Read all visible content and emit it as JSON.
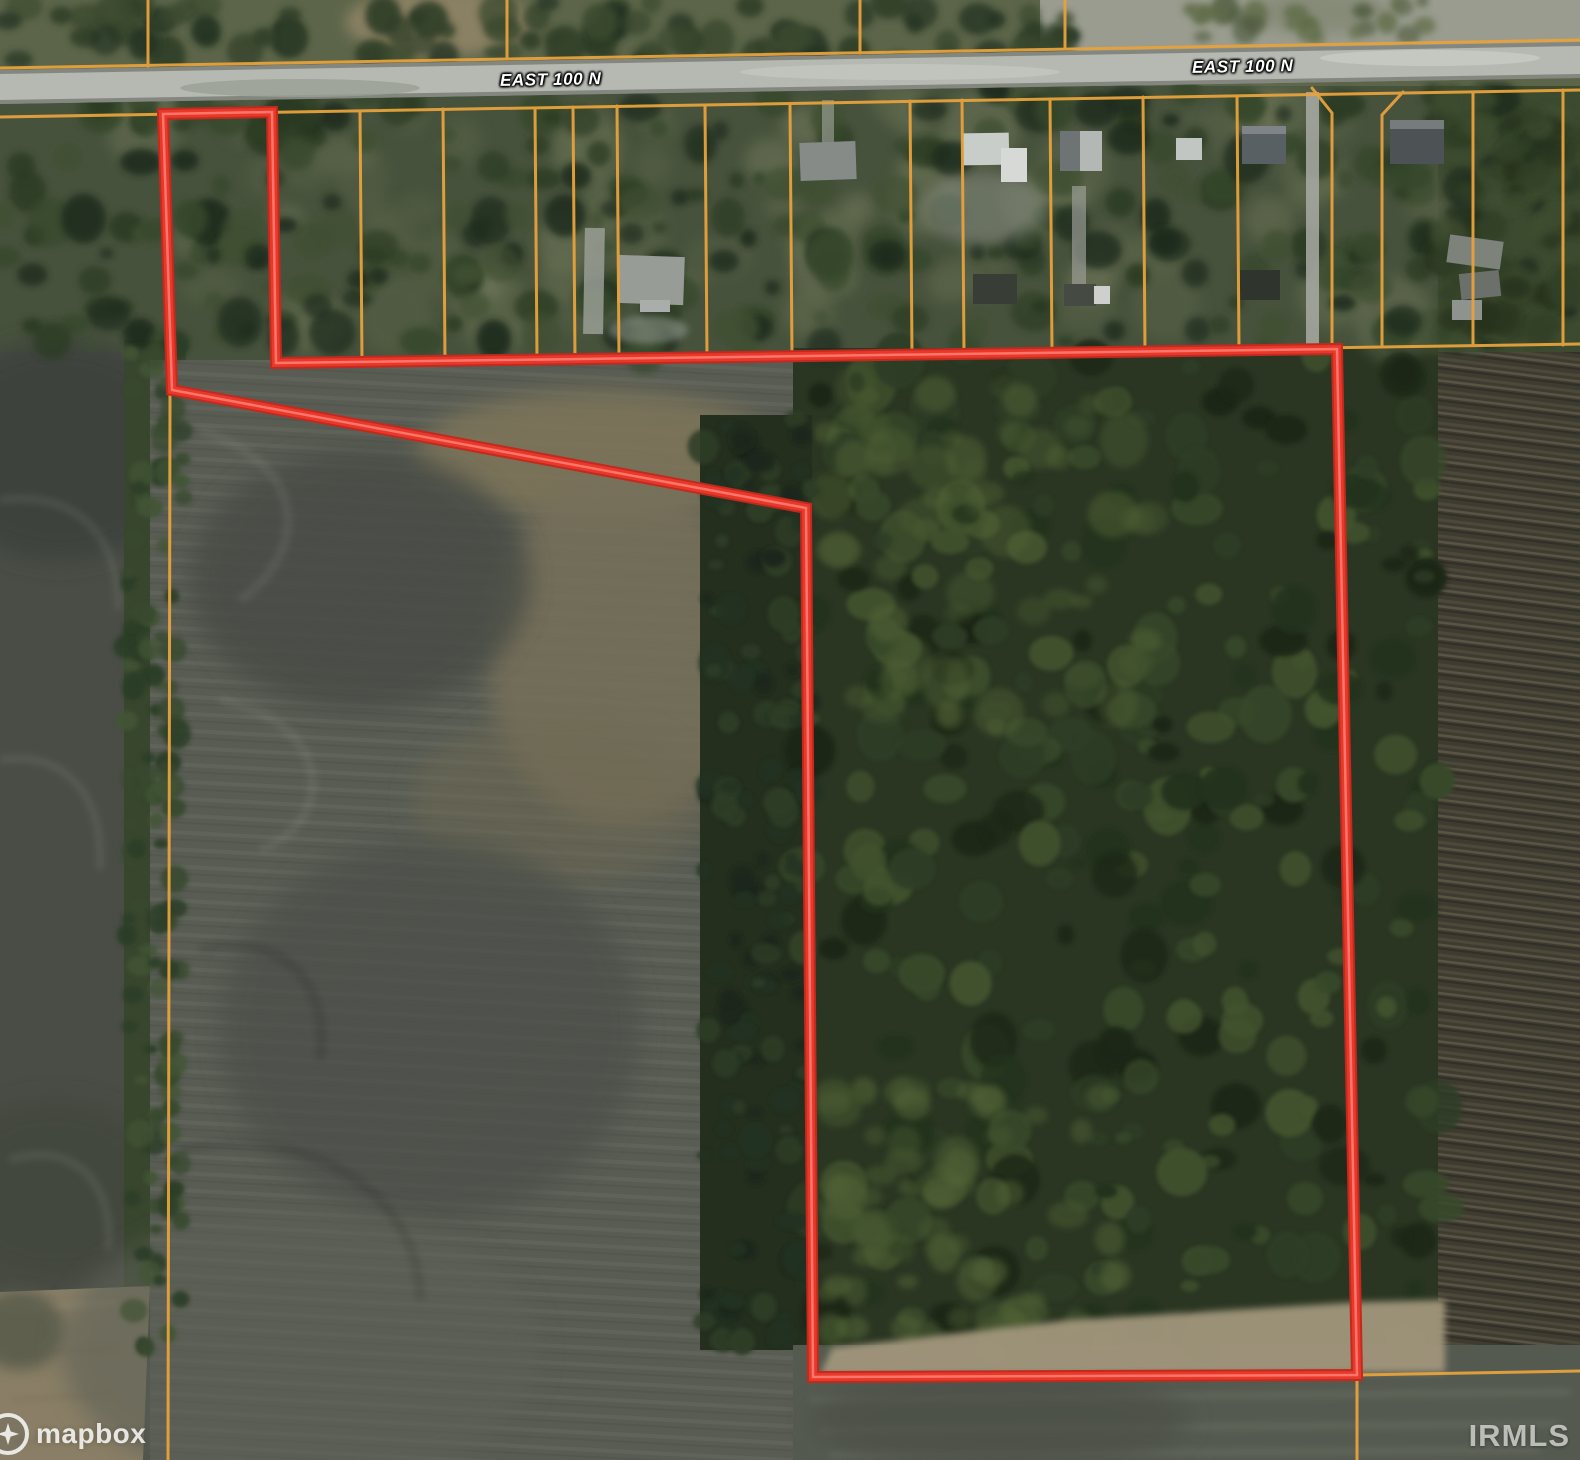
{
  "map": {
    "road_name": "EAST 100 N",
    "attribution": {
      "provider": "mapbox"
    },
    "watermark": "IRMLS",
    "colors": {
      "boundary_red": "#e8382b",
      "parcel_orange": "#e7a23c",
      "road_gray": "#b5b9b1"
    }
  }
}
